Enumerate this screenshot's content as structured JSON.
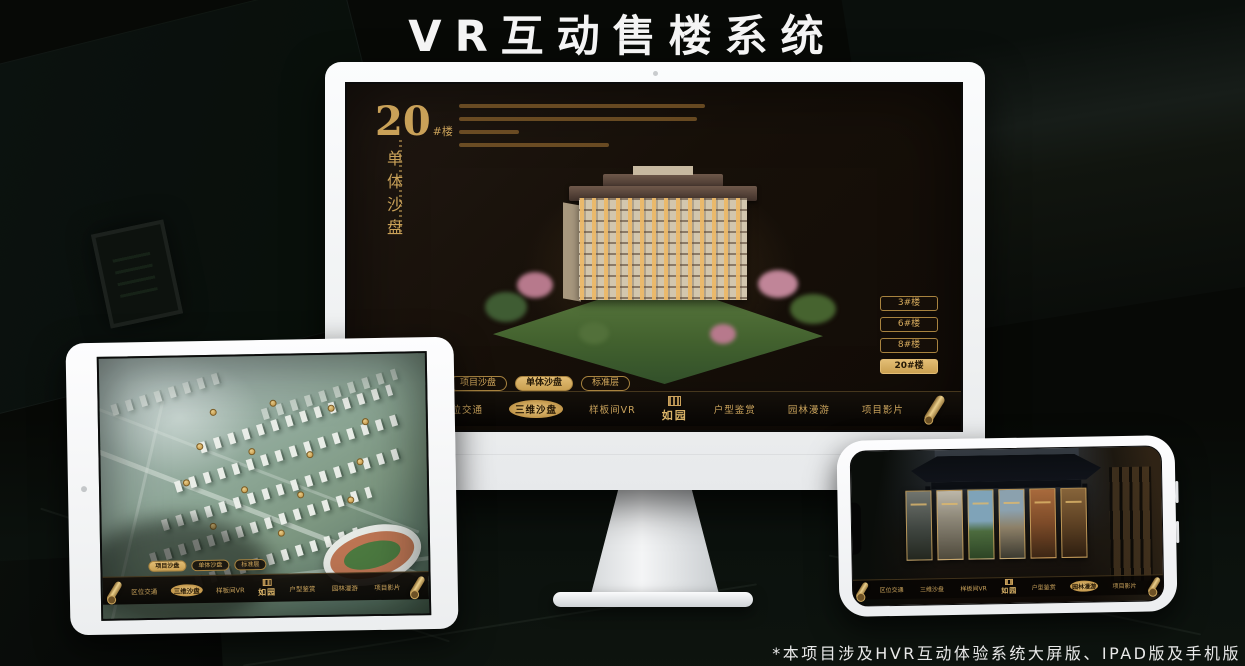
{
  "page": {
    "title": "VR互动售楼系统",
    "footnote": "*本项目涉及HVR互动体验系统大屏版、IPAD版及手机版"
  },
  "colors": {
    "gold_accent": "#c9a158",
    "gold_active": "#d9b26a",
    "screen_background": "#171009",
    "device_frame": "#f4f5f6"
  },
  "nav": {
    "logo": "如园",
    "items_left": [
      "区位交通",
      "三维沙盘",
      "样板间VR"
    ],
    "items_right": [
      "户型鉴赏",
      "园林漫游",
      "项目影片"
    ]
  },
  "monitor": {
    "headline": {
      "number": "20",
      "suffix": "#楼",
      "title_vertical": "单体沙盘"
    },
    "floor_buttons": [
      {
        "label": "3#楼"
      },
      {
        "label": "6#楼"
      },
      {
        "label": "8#楼"
      },
      {
        "label": "20#楼"
      }
    ],
    "active_floor": "20#楼",
    "subtabs": [
      {
        "label": "项目沙盘"
      },
      {
        "label": "单体沙盘"
      },
      {
        "label": "标准层"
      }
    ],
    "active_subtab": "单体沙盘",
    "active_nav": "三维沙盘"
  },
  "tablet": {
    "subtabs": [
      {
        "label": "项目沙盘"
      },
      {
        "label": "单体沙盘"
      },
      {
        "label": "标准层"
      }
    ],
    "active_subtab": "项目沙盘",
    "active_nav": "三维沙盘"
  },
  "phone": {
    "active_nav": "园林漫游"
  }
}
